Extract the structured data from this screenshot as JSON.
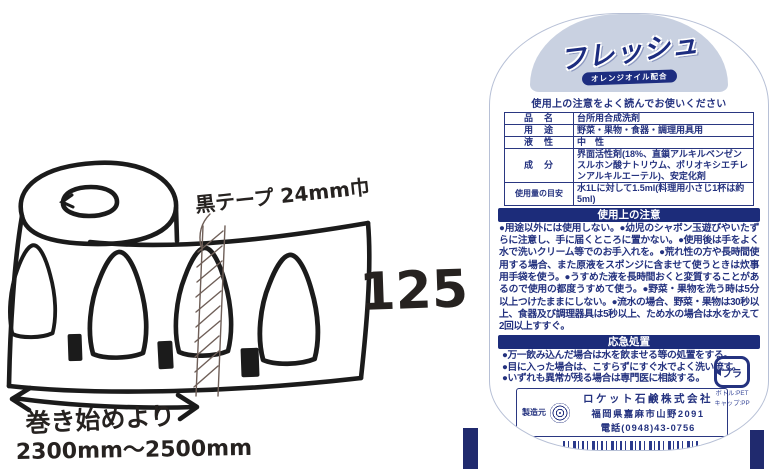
{
  "sketch": {
    "tape_label": "黒テープ 24mm巾",
    "height_label": "125",
    "note_line1": "巻き始めより",
    "note_line2": "2300mm〜2500mm"
  },
  "label": {
    "brand": "フレッシュ",
    "subtitle": "オレンジオイル配合",
    "notice": "使用上の注意をよく読んでお使いください",
    "spec_table": {
      "rows": [
        {
          "label": "品　名",
          "value": "台所用合成洗剤"
        },
        {
          "label": "用　途",
          "value": "野菜・果物・食器・調理用具用"
        },
        {
          "label": "液　性",
          "value": "中　性"
        },
        {
          "label": "成　分",
          "value": "界面活性剤(18%、直鎖アルキルベンゼンスルホン酸ナトリウム、ポリオキシエチレンアルキルエーテル)、安定化剤"
        },
        {
          "label": "使用量の目安",
          "value": "水1Lに対して1.5ml(料理用小さじ1杯は約5ml)"
        }
      ]
    },
    "usage_caution": {
      "title": "使用上の注意",
      "body": "●用途以外には使用しない。●幼児のシャボン玉遊びやいたずらに注意し、手に届くところに置かない。●使用後は手をよく水で洗いクリーム等でのお手入れを。●荒れ性の方や長時間使用する場合、また原液をスポンジに含ませて使うときは炊事用手袋を使う。●うすめた液を長時間おくと変質することがあるので使用の都度うすめて使う。●野菜・果物を洗う時は5分以上つけたままにしない。●流水の場合、野菜・果物は30秒以上、食器及び調理器具は5秒以上、ため水の場合は水をかえて2回以上すすぐ。"
    },
    "first_aid": {
      "title": "応急処置",
      "items": [
        "●万一飲み込んだ場合は水を飲ませる等の処置をする。",
        "●目に入った場合は、こすらずにすぐ水でよく洗い流す。",
        "●いずれも異常が残る場合は専門医に相談する。"
      ]
    },
    "manufacturer": {
      "label": "製造元",
      "name": "ロケット石鹸株式会社",
      "address": "福岡県嘉麻市山野2091",
      "phone": "電話(0948)43-0756"
    },
    "recycle": {
      "text": "プラ",
      "sub1": "ボトル:PET",
      "sub2": "キャップ:PP"
    },
    "volume": "600ml",
    "lot": "0609",
    "barcode_number": "4 903367 301437",
    "origin": "MADE IN JAPAN"
  },
  "colors": {
    "navy_text": "#24327f",
    "header_bar": "#1c2c7a",
    "dome_blue": "#c9d1e1",
    "barcode_blue": "#2b3a8c",
    "bottle_bar": "#202a6e",
    "marker_black": "#1b1b1b"
  }
}
